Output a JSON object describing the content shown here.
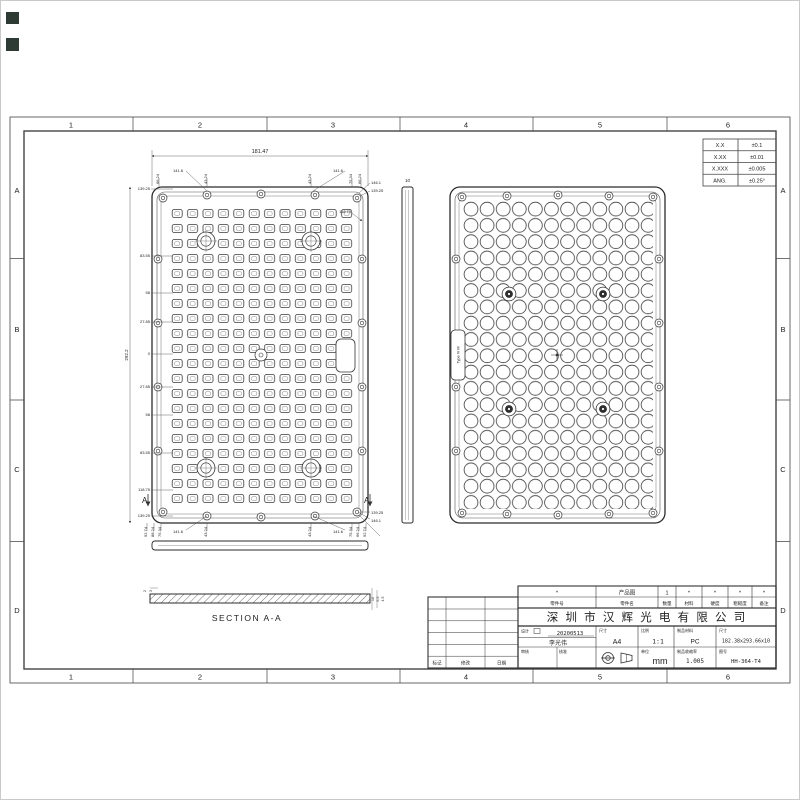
{
  "frame": {
    "columns": [
      "1",
      "2",
      "3",
      "4",
      "5",
      "6"
    ],
    "rows": [
      "A",
      "B",
      "C",
      "D"
    ]
  },
  "tolerance_table": {
    "rows": [
      {
        "label": "X.X",
        "value": "±0.1"
      },
      {
        "label": "X.XX",
        "value": "±0.01"
      },
      {
        "label": "X.XXX",
        "value": "±0.005"
      },
      {
        "label": "ANG.",
        "value": "±0.25°"
      }
    ]
  },
  "front_view": {
    "dim_total_width": "181.47",
    "dim_total_height": "292.2",
    "top_offsets": [
      "66.24",
      "43.24",
      "43.24",
      "75.34",
      "66.24"
    ],
    "top_leader": "141.6",
    "top_right": [
      "146.1",
      "139.25"
    ],
    "left_offsets": [
      "139.25",
      "83.55",
      "58",
      "27.85",
      "0",
      "27.85",
      "58",
      "83.55",
      "118.75",
      "139.25"
    ],
    "interior_dim": "118.75",
    "bottom_cluster_left": [
      "92.74",
      "88.24",
      "75.34"
    ],
    "bottom_offsets": [
      "43.24",
      "43.24"
    ],
    "bottom_cluster_right": [
      "75.34",
      "66.24",
      "92.74"
    ],
    "bottom_leader": "141.6",
    "bottom_right": [
      "139.25",
      "146.1"
    ],
    "section_letter": "A"
  },
  "side_view": {
    "thickness": "10"
  },
  "section_view": {
    "label": "SECTION A-A",
    "dims_left": [
      "2",
      "3"
    ],
    "dims_right": [
      "10",
      "6.5",
      "4.5"
    ]
  },
  "back_view": {
    "tab_label": "Type IV M"
  },
  "title_block": {
    "header": {
      "values": [
        "*",
        "产品图",
        "1",
        "*",
        "*",
        "*",
        "*"
      ],
      "labels": [
        "零件号",
        "零件名",
        "数量",
        "材料",
        "硬度",
        "粗糙度",
        "备注"
      ]
    },
    "company": "深 圳 市 汉 辉 光 电  有 限 公 司",
    "design_label": "设计",
    "design_date": "20200513",
    "designer": "李光伟",
    "paper_label": "尺寸",
    "paper": "A4",
    "scale_label": "比例",
    "scale": "1:1",
    "material_label": "制品材料",
    "material": "PC",
    "dim_label": "尺寸",
    "dimensions": "182.38x293.66x10",
    "check_label": "审核",
    "approve_label": "核准",
    "unit_label": "单位",
    "unit": "mm",
    "shrink_label": "制品收缩率",
    "shrinkage": "1.005",
    "drawing_no_label": "图号",
    "drawing_no": "HH-364-T4",
    "revision_footer": [
      "标记",
      "修改",
      "日期"
    ]
  }
}
